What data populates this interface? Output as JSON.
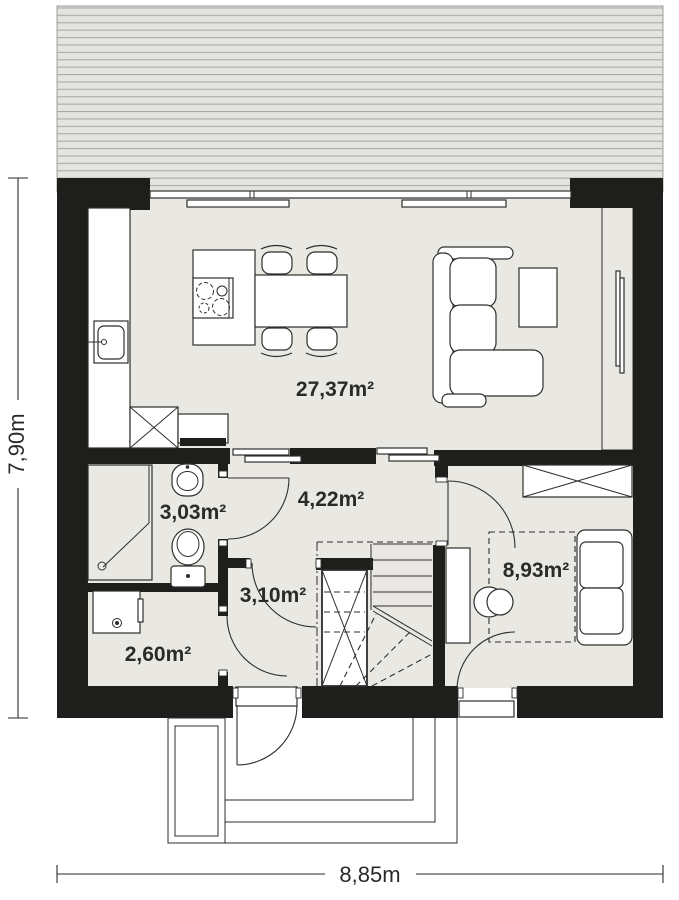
{
  "plan": {
    "rooms": [
      {
        "id": "living-kitchen",
        "area": "27,37m²"
      },
      {
        "id": "hall",
        "area": "4,22m²"
      },
      {
        "id": "bathroom",
        "area": "3,03m²"
      },
      {
        "id": "corridor",
        "area": "3,10m²"
      },
      {
        "id": "utility",
        "area": "2,60m²"
      },
      {
        "id": "bedroom",
        "area": "8,93m²"
      }
    ],
    "dimensions": {
      "height_label": "7,90m",
      "width_label": "8,85m"
    },
    "colors": {
      "wall": "#1e1e1c",
      "floor": "#e9e8e2",
      "line": "#2e2e2c",
      "text": "#2a2a28",
      "roof_fill": "#e3e3e0",
      "roof_line": "#aaaaa7",
      "roof_edge": "#9c9c99"
    }
  }
}
